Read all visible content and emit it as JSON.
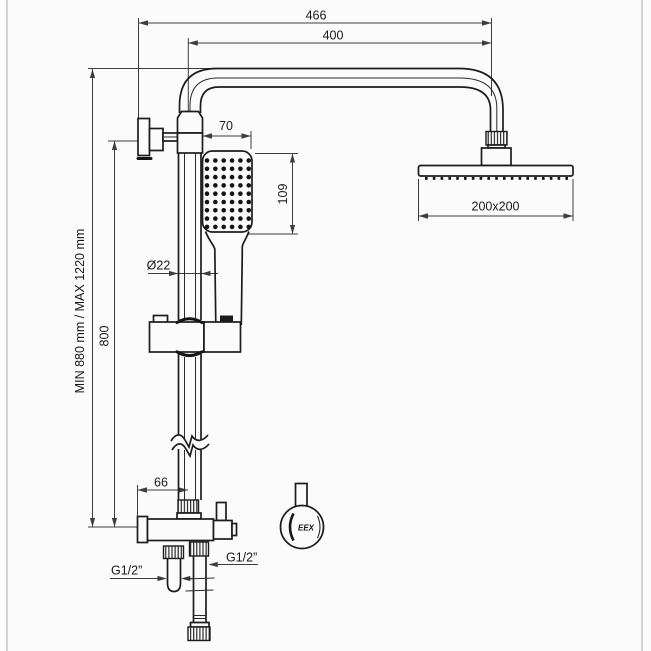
{
  "drawing": {
    "type": "technical-dimension-drawing",
    "subject": "thermostatic shower column with rain head and hand shower",
    "dimensions": {
      "top_outer": "466",
      "top_inner": "400",
      "handshower_width": "70",
      "handshower_height": "109",
      "pipe_diameter": "Ø22",
      "column_height_range": "MIN 880 mm / MAX 1220 mm",
      "bracket_to_mixer": "800",
      "mixer_offset": "66",
      "head_size": "200x200",
      "thread_left": "G1/2”",
      "thread_right": "G1/2”"
    },
    "logo_text": "EEX",
    "nozzles": {
      "hand_shower": {
        "cols": 6,
        "rows": 9,
        "x0": 207,
        "y0": 160.5,
        "dx": 8.35,
        "dy": 8.3,
        "r": 2.3
      },
      "rain_head": {
        "count": 19,
        "x0": 425,
        "y": 177,
        "dx": 7.8,
        "w": 2.6,
        "h": 2.8
      }
    },
    "colors": {
      "line": "#1c1c1c",
      "dimension": "#3d3d3d",
      "background": "#fbfbfb",
      "page_border": "#c6c6c6"
    }
  }
}
